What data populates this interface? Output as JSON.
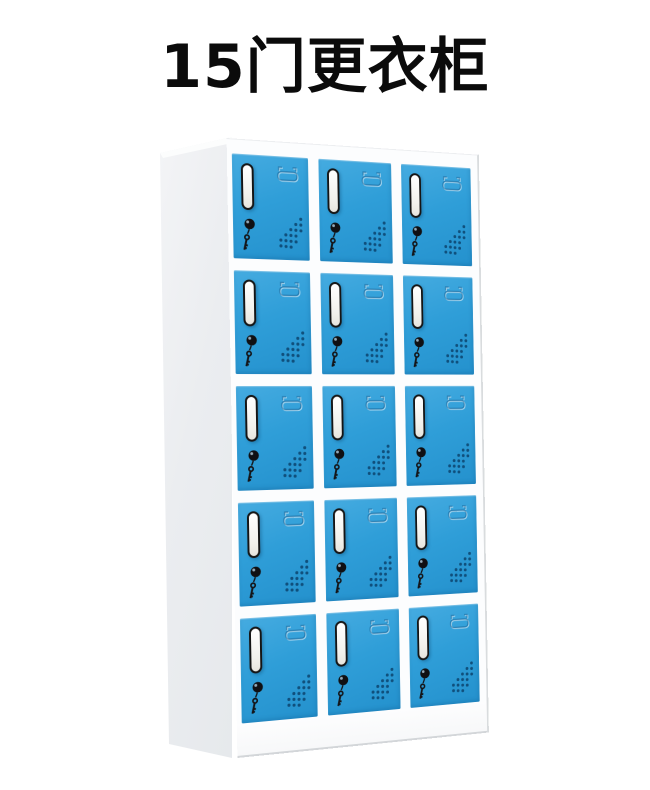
{
  "title": {
    "text": "15门更衣柜",
    "color": "#0b0b0b"
  },
  "cabinet": {
    "type": "locker-cabinet",
    "rows": 5,
    "columns": 3,
    "door_count": 15,
    "colors": {
      "door_blue": "#2f9ed8",
      "door_blue_light": "#45abe0",
      "door_blue_dark": "#2491cd",
      "frame_white": "#fcfdfe",
      "side_gray": "#ebedf0",
      "slot_border": "#151515",
      "slot_fill": "#f4f3ee",
      "lock_black": "#101013",
      "key_black": "#141417",
      "vent_dot": "#0c456f",
      "handle_line": "rgba(10,74,124,0.42)",
      "handle_highlight": "rgba(255,255,255,0.55)",
      "edge_line": "#d3d6d9"
    },
    "door_features": [
      {
        "icon": "name-card-slot-icon"
      },
      {
        "icon": "lock-and-key-icon"
      },
      {
        "icon": "handle-recess-icon"
      },
      {
        "icon": "vent-holes-icon"
      }
    ]
  }
}
